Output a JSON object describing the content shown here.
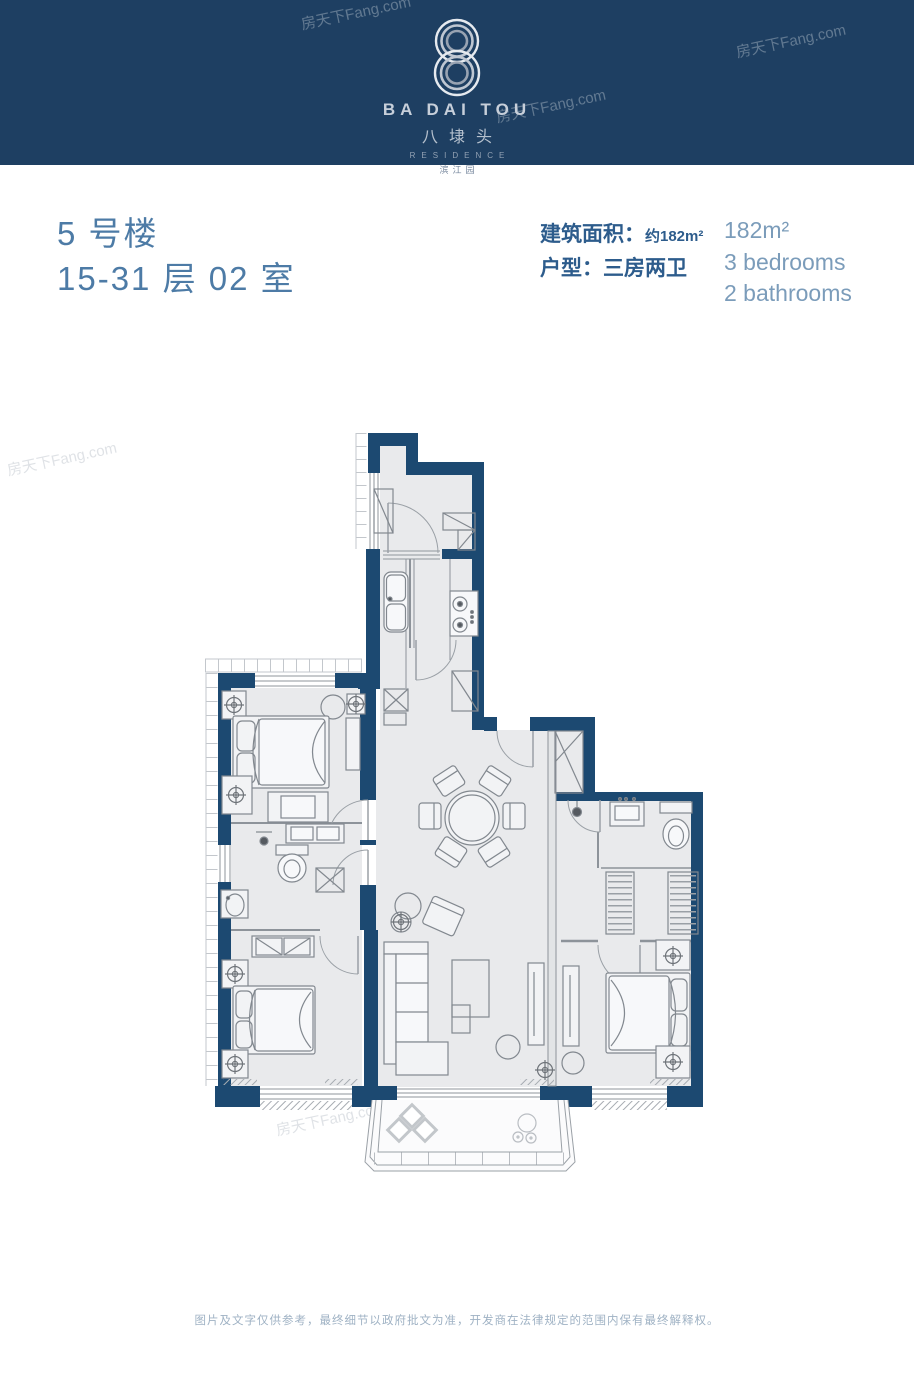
{
  "watermark_text": "房天下Fang.com",
  "header": {
    "logo_latin": "BA DAI TOU",
    "logo_cn": "八埭头",
    "residence": "RESIDENCE",
    "estate_cn": "滨江园"
  },
  "unit": {
    "building": "5 号楼",
    "floors_room": "15-31 层 02 室"
  },
  "specs": {
    "area_label": "建筑面积：",
    "area_value": "约182m²",
    "type_label": "户型：",
    "type_value": "三房两卫"
  },
  "specs_en": {
    "area": "182m²",
    "bedrooms": "3 bedrooms",
    "bathrooms": "2 bathrooms"
  },
  "footer": {
    "disclaimer": "图片及文字仅供参考，最终细节以政府批文为准，开发商在法律规定的范围内保有最终解释权。"
  },
  "colors": {
    "header_bg": "#1e3f62",
    "plan_wall": "#1c4971",
    "plan_floor": "#e9eaec",
    "title_text": "#4d7ba6",
    "spec_text": "#2d5c8c",
    "english_text": "#7b9cba",
    "footer_text": "#9fb2c4",
    "logo_silver": "#c7cfda"
  }
}
